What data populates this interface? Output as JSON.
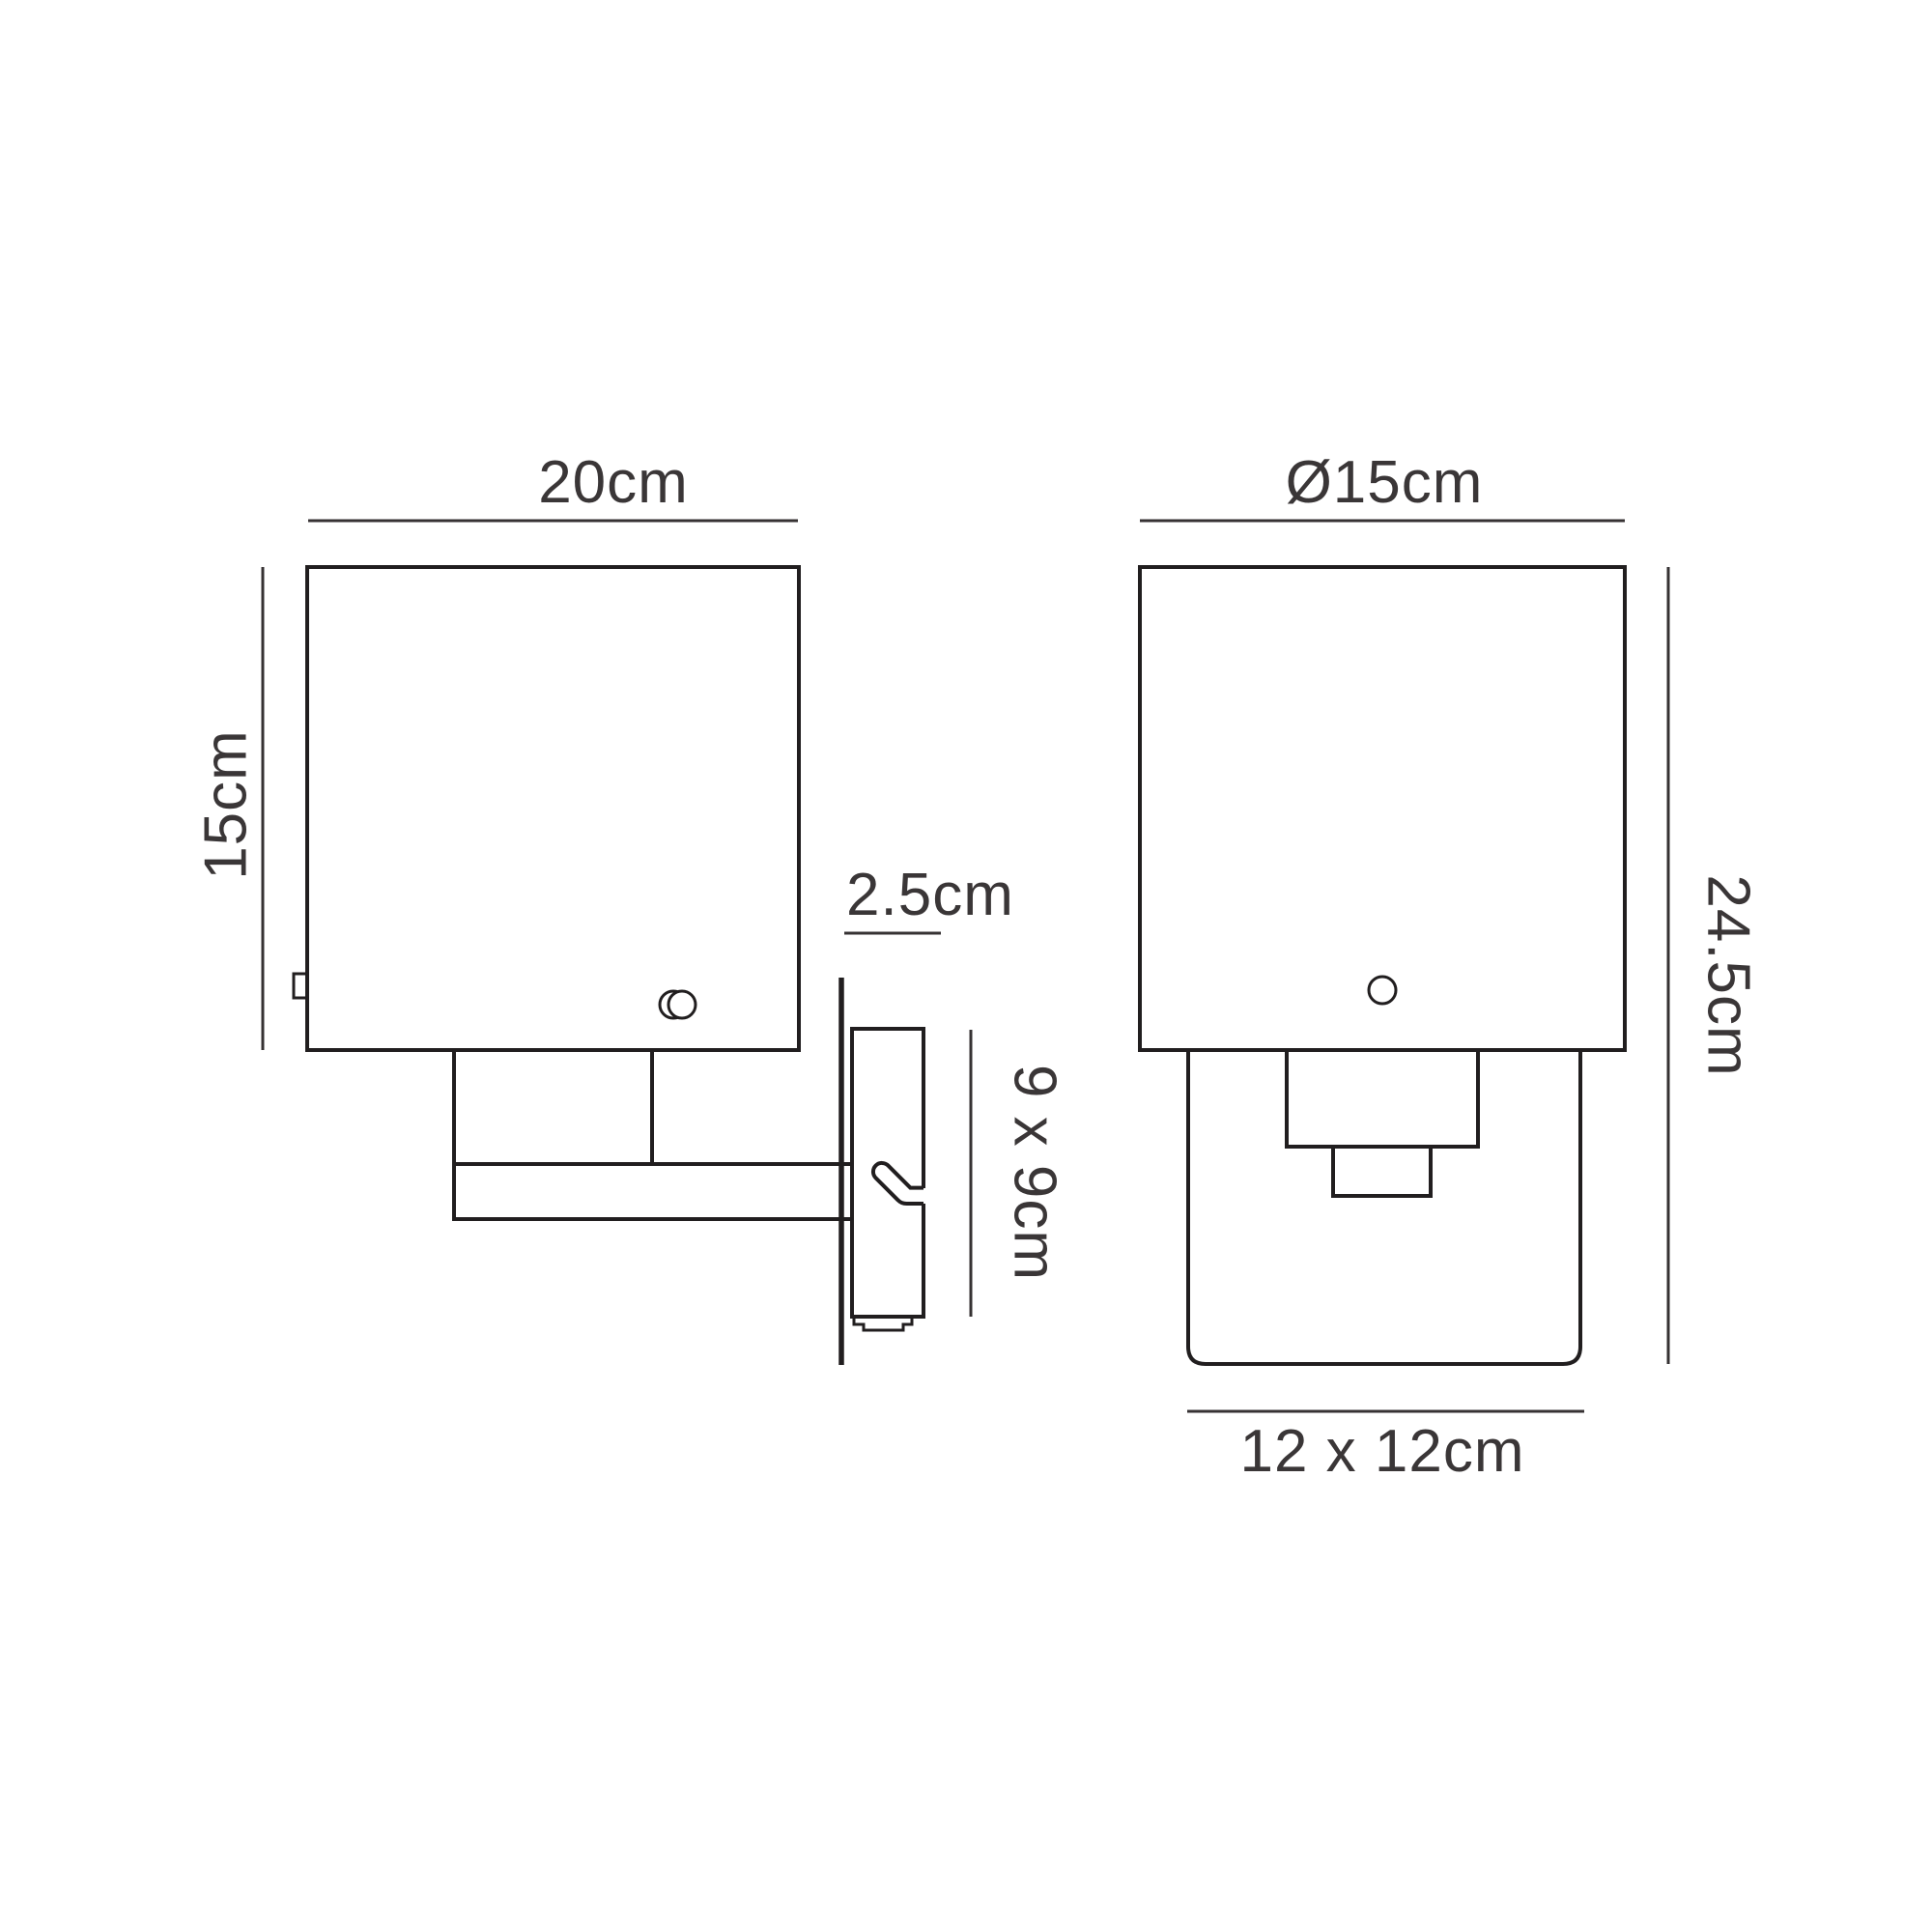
{
  "side_view": {
    "shade_width_label": "20cm",
    "shade_height_label": "15cm",
    "backplate_depth_label": "2.5cm",
    "backplate_size_label": "9 x 9cm"
  },
  "front_view": {
    "shade_diameter_label": "Ø15cm",
    "total_height_label": "24.5cm",
    "glass_size_label": "12 x 12cm"
  },
  "colors": {
    "background": "#ffffff",
    "line": "#211e1f",
    "dimension_line": "#363233",
    "text": "#3a3637"
  }
}
